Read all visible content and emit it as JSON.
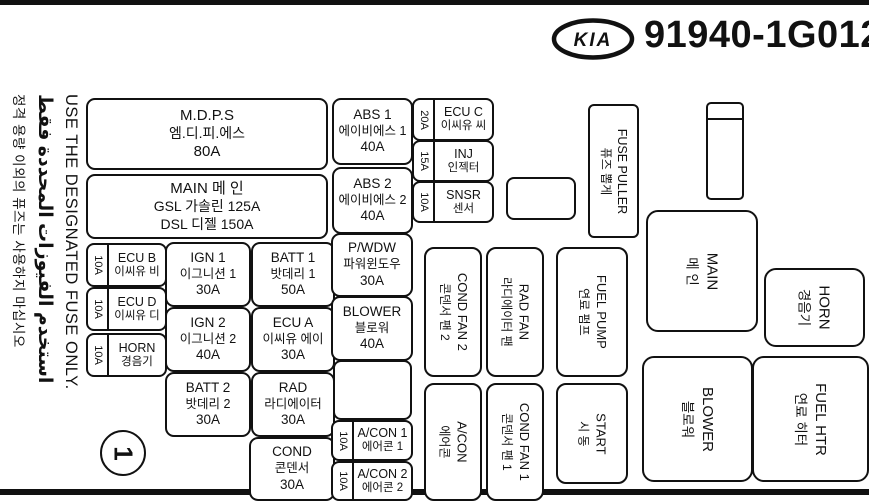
{
  "header": {
    "brand": "KIA",
    "part_number": "91940-1G012"
  },
  "warning": {
    "english": "USE THE DESIGNATED FUSE ONLY.",
    "arabic": "استخدم الفيوزات المحددة فقط",
    "korean": "정격 용량 이외의 퓨즈는 사용하지 마십시오"
  },
  "fuses": {
    "mdps": {
      "name": "M.D.P.S",
      "korean": "엠.디.피.에스",
      "amp": "80A"
    },
    "main": {
      "line1": "MAIN 메 인",
      "line2": "GSL 가솔린 125A",
      "line3": "DSL 디젤 150A"
    },
    "ecu_b": {
      "amp": "10A",
      "name": "ECU B",
      "korean": "이씨유 비"
    },
    "ecu_d": {
      "amp": "10A",
      "name": "ECU D",
      "korean": "이씨유 디"
    },
    "horn": {
      "amp": "10A",
      "name": "HORN",
      "korean": "경음기"
    },
    "ign1": {
      "name": "IGN 1",
      "korean": "이그니션 1",
      "amp": "30A"
    },
    "batt1": {
      "name": "BATT 1",
      "korean": "밧데리 1",
      "amp": "50A"
    },
    "ign2": {
      "name": "IGN 2",
      "korean": "이그니션 2",
      "amp": "40A"
    },
    "ecu_a": {
      "name": "ECU A",
      "korean": "이씨유 에이",
      "amp": "30A"
    },
    "batt2": {
      "name": "BATT 2",
      "korean": "밧데리 2",
      "amp": "30A"
    },
    "rad": {
      "name": "RAD",
      "korean": "라디에이터",
      "amp": "30A"
    },
    "cond": {
      "name": "COND",
      "korean": "콘덴서",
      "amp": "30A"
    },
    "abs1": {
      "name": "ABS 1",
      "korean": "에이비에스 1",
      "amp": "40A"
    },
    "abs2": {
      "name": "ABS 2",
      "korean": "에이비에스 2",
      "amp": "40A"
    },
    "pwdw": {
      "name": "P/WDW",
      "korean": "파워윈도우",
      "amp": "30A"
    },
    "blower": {
      "name": "BLOWER",
      "korean": "블로워",
      "amp": "40A"
    },
    "ecu_c": {
      "amp": "20A",
      "name": "ECU C",
      "korean": "이씨유 씨"
    },
    "inj": {
      "amp": "15A",
      "name": "INJ",
      "korean": "인젝터"
    },
    "snsr": {
      "amp": "10A",
      "name": "SNSR",
      "korean": "센서"
    },
    "acon1": {
      "amp": "10A",
      "name": "A/CON 1",
      "korean": "에어콘 1"
    },
    "acon2": {
      "amp": "10A",
      "name": "A/CON 2",
      "korean": "에어콘 2"
    }
  },
  "relays": {
    "cond_fan2": {
      "name": "COND FAN 2",
      "korean": "콘덴서 팬 2"
    },
    "rad_fan": {
      "name": "RAD FAN",
      "korean": "라디에이터 팬"
    },
    "fuel_pump": {
      "name": "FUEL PUMP",
      "korean": "연료 펌프"
    },
    "acon": {
      "name": "A/CON",
      "korean": "에어콘"
    },
    "cond_fan1": {
      "name": "COND FAN 1",
      "korean": "콘덴서 팬 1"
    },
    "start": {
      "name": "START",
      "korean": "시 동"
    },
    "main": {
      "name": "MAIN",
      "korean": "메 인"
    },
    "horn": {
      "name": "HORN",
      "korean": "경음기"
    },
    "blower": {
      "name": "BLOWER",
      "korean": "블로워"
    },
    "fuel_htr": {
      "name": "FUEL HTR",
      "korean": "연료 히터"
    }
  },
  "fuse_puller": {
    "name": "FUSE PULLER",
    "korean": "퓨즈 뽑게"
  },
  "page_marker": "1",
  "colors": {
    "ink": "#111111",
    "background": "#ffffff"
  }
}
